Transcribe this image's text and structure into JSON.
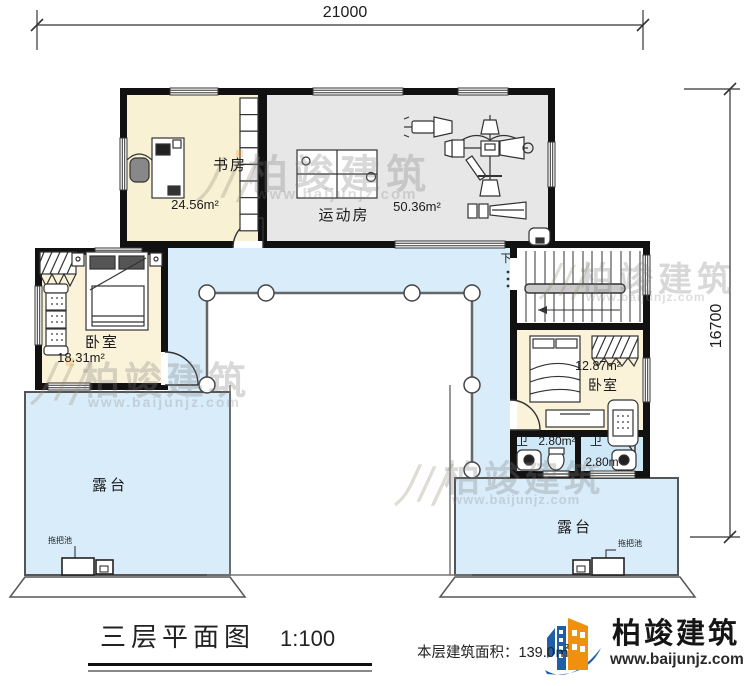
{
  "dimensions": {
    "top": "21000",
    "right": "16700"
  },
  "rooms": {
    "study": {
      "name": "书房",
      "area": "24.56m²"
    },
    "gym": {
      "name": "运动房",
      "area": "50.36m²"
    },
    "bedroom_left": {
      "name": "卧室",
      "area": "18.31m²"
    },
    "bedroom_right": {
      "name": "卧室",
      "area": "12.87m²"
    },
    "bath_left": {
      "name": "卫",
      "area": "2.80m²"
    },
    "bath_right": {
      "name": "卫",
      "area": "2.80m"
    },
    "terrace_left": {
      "name": "露台"
    },
    "terrace_right": {
      "name": "露台"
    },
    "stair": {
      "direction_label": "下"
    }
  },
  "fixtures": {
    "mop_sink": "拖把池"
  },
  "titleblock": {
    "plan_name": "三层平面图",
    "scale": "1:100",
    "area_note": "本层建筑面积：139.0㎡"
  },
  "logo": {
    "brand": "柏竣建筑",
    "url": "www.baijunjz.com"
  },
  "watermark": {
    "brand": "柏竣建筑",
    "url": "www.baijunjz.com",
    "mark": "川"
  },
  "colors": {
    "room_cream": "#f8f1d4",
    "gym_gray": "#e7e7e7",
    "terrace_blue": "#d9ecfa",
    "bath_blue": "#cfe8f7",
    "wall_black": "#111111",
    "logo_blue": "#1f5fa8",
    "logo_orange": "#f0900f"
  }
}
